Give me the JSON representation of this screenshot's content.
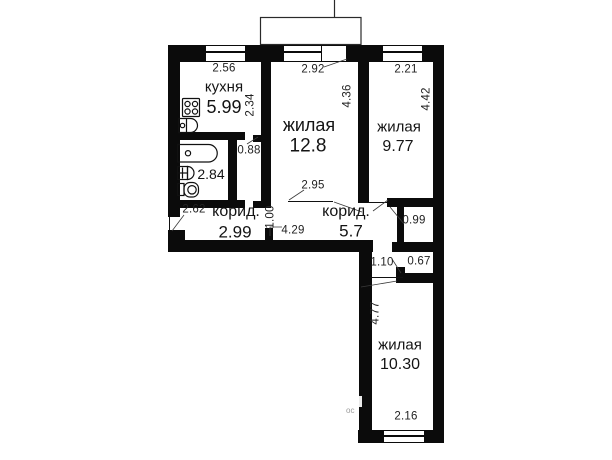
{
  "rooms": {
    "kitchen": {
      "label": "кухня",
      "area": "5.99"
    },
    "living_main": {
      "label": "жилая",
      "area": "12.8"
    },
    "living_right": {
      "label": "жилая",
      "area": "9.77"
    },
    "living_bottom": {
      "label": "жилая",
      "area": "10.30"
    },
    "bathroom": {
      "area": "2.84"
    },
    "corridor_left": {
      "label": "корид.",
      "area": "2.99"
    },
    "corridor_right": {
      "label": "корид.",
      "area": "5.7"
    }
  },
  "dimensions": {
    "kitchen_width": "2.56",
    "living_main_width": "2.92",
    "living_right_width": "2.21",
    "kitchen_depth": "2.34",
    "living_main_depth": "4.36",
    "living_right_depth": "4.42",
    "kitchen_passage_width": "0.88",
    "living_main_door_offset": "2.95",
    "corridor_left_width": "2.62",
    "corridor_door_width": "1.00",
    "corridor_right_length": "4.29",
    "closet_width": "0.99",
    "living_bottom_door_width": "1.10",
    "recess_depth": "0.67",
    "living_bottom_depth": "4.77",
    "living_bottom_width": "2.16"
  },
  "watermark": "ос"
}
